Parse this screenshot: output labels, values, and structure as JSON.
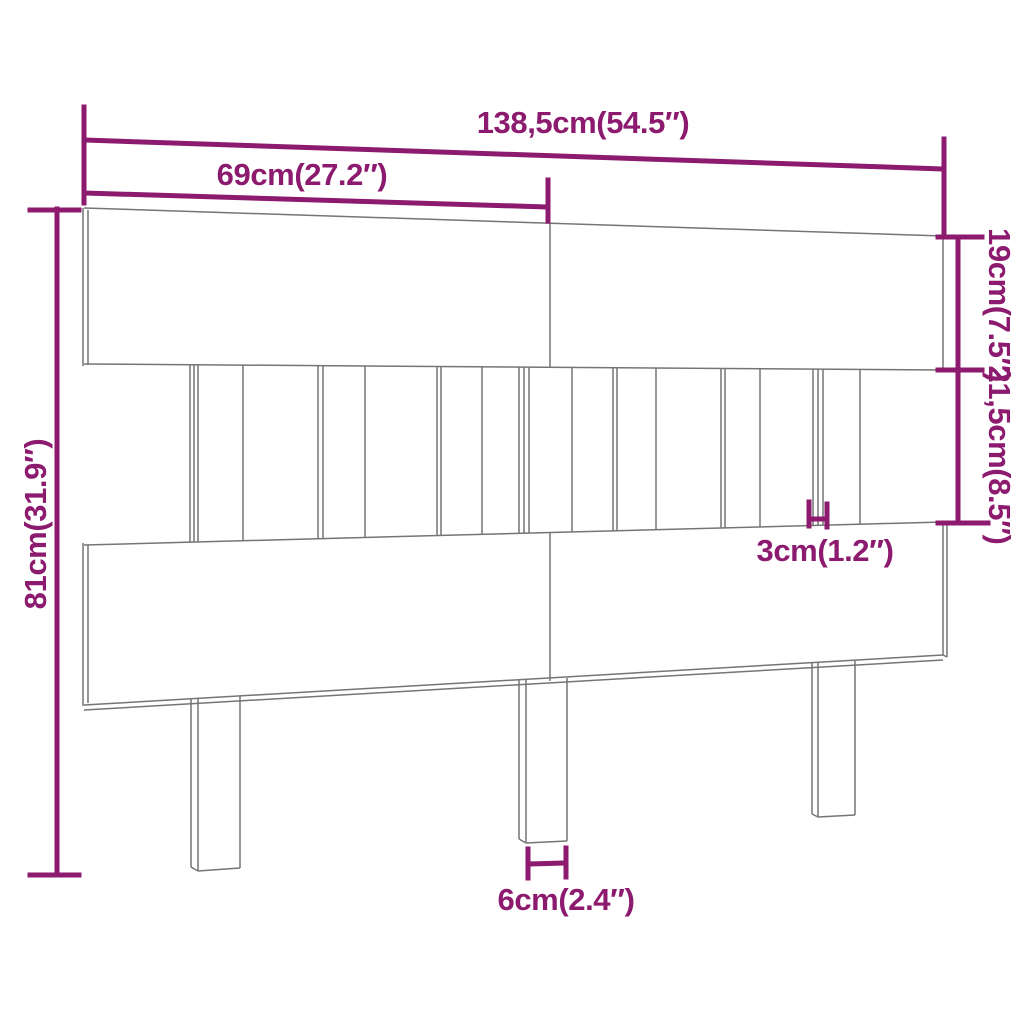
{
  "page": {
    "description": "Technical dimension diagram of a slatted wooden bed headboard with three legs, drawn in perspective outline with magenta measurement annotations"
  },
  "colors": {
    "background": "#ffffff",
    "dimension_annotation": "#8C1A6E",
    "drawing_outline": "#757575"
  },
  "dimension_labels": {
    "overall_width": "138,5cm(54.5″)",
    "half_width": "69cm(27.2″)",
    "top_panel_height": "19cm(7.5″)",
    "slat_section_height": "21,5cm(8.5″)",
    "overall_height": "81cm(31.9″)",
    "slat_gap": "3cm(1.2″)",
    "leg_width": "6cm(2.4″)"
  },
  "diagram": {
    "outline": {
      "name": "headboard-outline-line",
      "stroke_width": 1.5,
      "linecap": "butt",
      "segments": [
        [
          84,
          208,
          943,
          236
        ],
        [
          84,
          364,
          943,
          370
        ],
        [
          83,
          208,
          83,
          366
        ],
        [
          88,
          210,
          88,
          365
        ],
        [
          943,
          236,
          943,
          370
        ],
        [
          550,
          223,
          550,
          368
        ],
        [
          84,
          545,
          943,
          522
        ],
        [
          190,
          365,
          190,
          542
        ],
        [
          194,
          365,
          194,
          542
        ],
        [
          198,
          365,
          198,
          542
        ],
        [
          243,
          365,
          243,
          541
        ],
        [
          318,
          366,
          318,
          539
        ],
        [
          323,
          366,
          323,
          539
        ],
        [
          365,
          366,
          365,
          537
        ],
        [
          437,
          366,
          437,
          536
        ],
        [
          441,
          366,
          441,
          535
        ],
        [
          482,
          367,
          482,
          534
        ],
        [
          519,
          367,
          519,
          533
        ],
        [
          524,
          367,
          524,
          533
        ],
        [
          529,
          367,
          529,
          533
        ],
        [
          572,
          367,
          572,
          532
        ],
        [
          613,
          368,
          613,
          531
        ],
        [
          617,
          368,
          617,
          531
        ],
        [
          656,
          368,
          656,
          530
        ],
        [
          721,
          368,
          721,
          528
        ],
        [
          725,
          368,
          725,
          528
        ],
        [
          760,
          369,
          760,
          527
        ],
        [
          813,
          369,
          813,
          525
        ],
        [
          818,
          369,
          818,
          525
        ],
        [
          823,
          369,
          823,
          525
        ],
        [
          860,
          369,
          860,
          524
        ],
        [
          84,
          705,
          943,
          655
        ],
        [
          84,
          710,
          943,
          660
        ],
        [
          83,
          543,
          83,
          706
        ],
        [
          88,
          545,
          88,
          703
        ],
        [
          943,
          522,
          943,
          655
        ],
        [
          947,
          524,
          947,
          657
        ],
        [
          943,
          655,
          947,
          657
        ],
        [
          550,
          533,
          550,
          681
        ],
        [
          191,
          699,
          191,
          867
        ],
        [
          198,
          699,
          198,
          871
        ],
        [
          240,
          696,
          240,
          868
        ],
        [
          198,
          871,
          240,
          868
        ],
        [
          191,
          867,
          198,
          871
        ],
        [
          519,
          680,
          519,
          839
        ],
        [
          526,
          680,
          526,
          843
        ],
        [
          567,
          678,
          567,
          841
        ],
        [
          526,
          843,
          567,
          841
        ],
        [
          519,
          839,
          526,
          843
        ],
        [
          812,
          663,
          812,
          814
        ],
        [
          818,
          663,
          818,
          817
        ],
        [
          855,
          661,
          855,
          815
        ],
        [
          818,
          817,
          855,
          815
        ],
        [
          812,
          814,
          818,
          817
        ]
      ]
    },
    "dimensions": {
      "name": "dimension-line",
      "stroke_width": 5,
      "linecap": "square",
      "segments": [
        [
          84,
          140,
          944,
          169
        ],
        [
          84,
          107,
          84,
          203
        ],
        [
          944,
          139,
          944,
          235
        ],
        [
          84,
          193,
          548,
          207
        ],
        [
          548,
          180,
          548,
          221
        ],
        [
          958,
          237,
          958,
          523
        ],
        [
          938,
          237,
          982,
          237
        ],
        [
          938,
          370,
          982,
          370
        ],
        [
          938,
          523,
          988,
          523
        ],
        [
          57,
          209,
          57,
          875
        ],
        [
          30,
          210,
          79,
          210
        ],
        [
          30,
          875,
          79,
          875
        ],
        [
          809,
          502,
          809,
          526
        ],
        [
          827,
          504,
          827,
          527
        ],
        [
          809,
          519,
          827,
          519
        ],
        [
          528,
          849,
          528,
          878
        ],
        [
          566,
          848,
          566,
          877
        ],
        [
          528,
          864,
          566,
          863
        ]
      ]
    }
  }
}
